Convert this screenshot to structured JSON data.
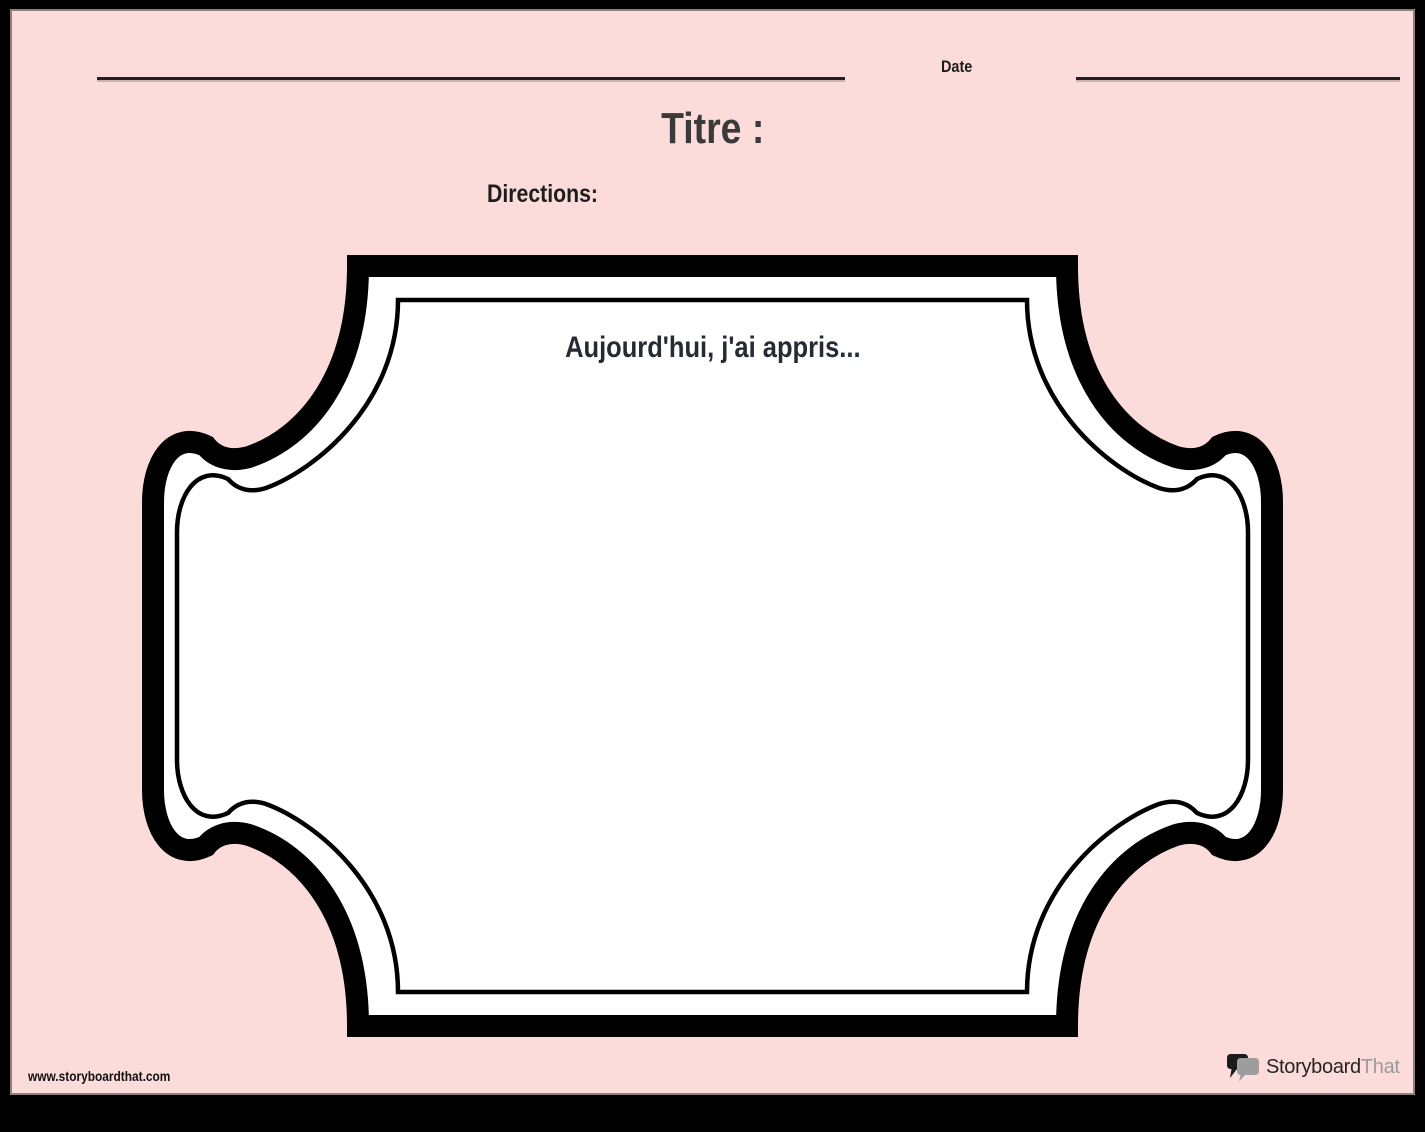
{
  "card": {
    "background_color": "#fcdcda",
    "page_border_color": "#000000"
  },
  "header": {
    "date_label": "Date",
    "title": "Titre :",
    "directions_label": "Directions:"
  },
  "frame": {
    "prompt": "Aujourd'hui, j'ai appris...",
    "stroke_color": "#000000",
    "fill_color": "#ffffff"
  },
  "footer": {
    "website_url": "www.storyboardthat.com",
    "logo": {
      "primary": "Storyboard",
      "secondary": "That",
      "primary_color": "#242424",
      "secondary_color": "#9b9b9b"
    }
  },
  "colors": {
    "title_text": "#3a3a3a",
    "label_text": "#1d1d1d",
    "prompt_text": "#262b33",
    "line_color": "#231f20"
  }
}
